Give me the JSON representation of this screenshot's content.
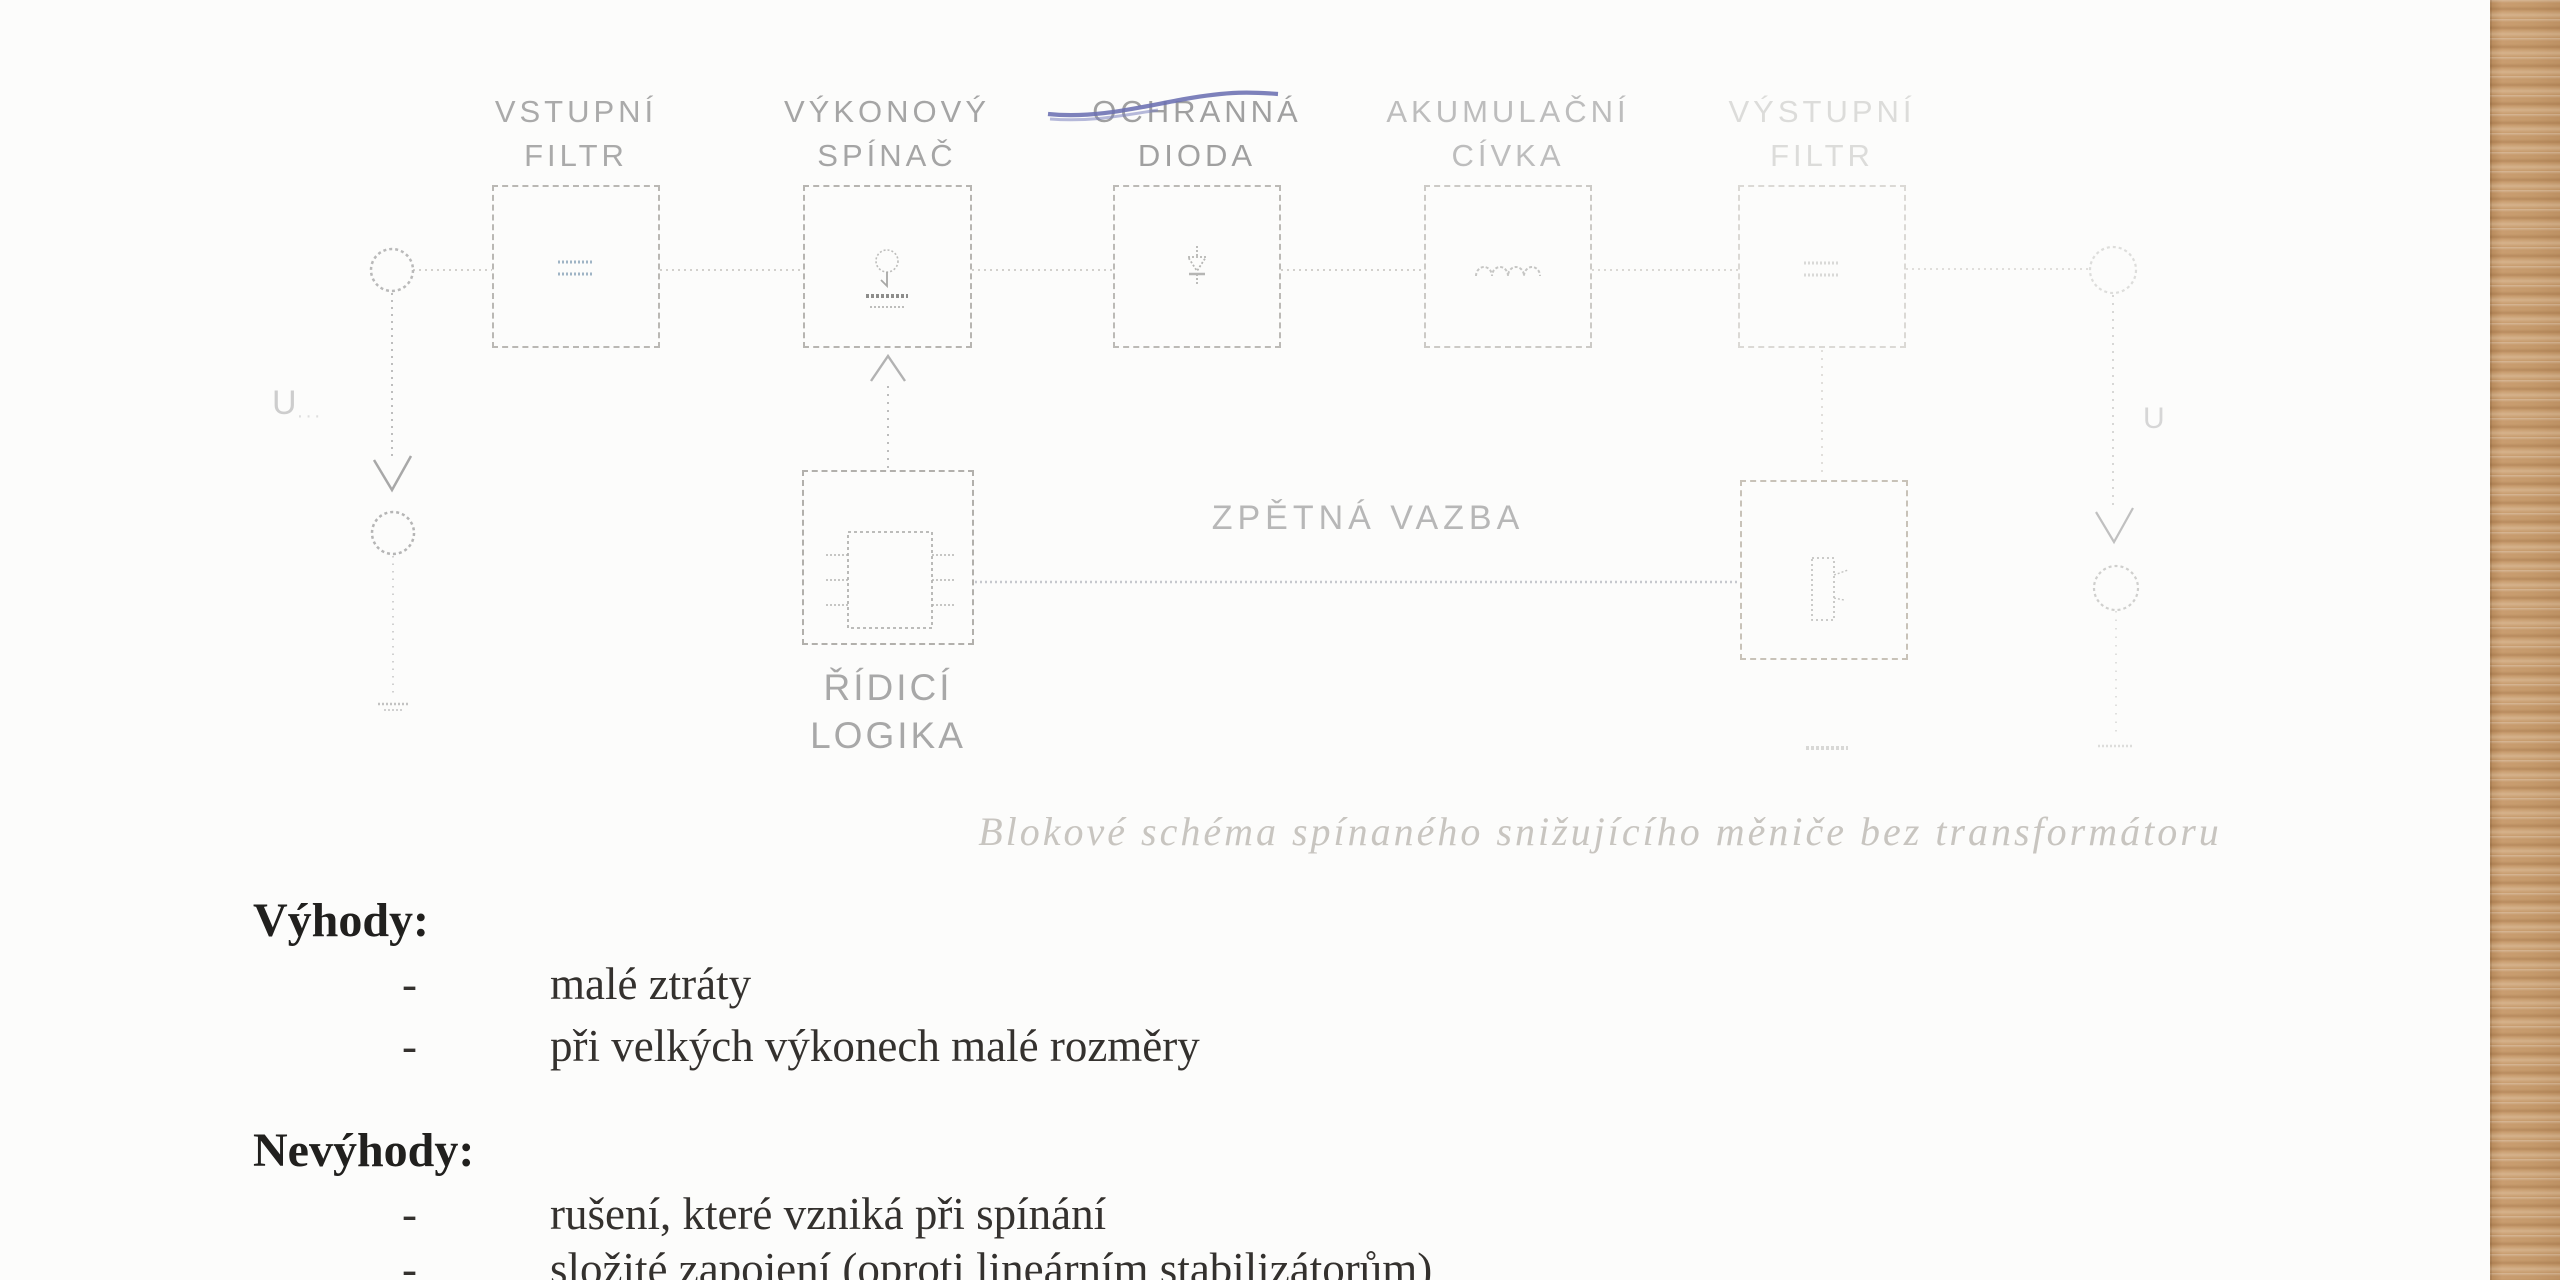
{
  "diagram": {
    "blocks": [
      {
        "line1": "VSTUPNÍ",
        "line2": "FILTR"
      },
      {
        "line1": "VÝKONOVÝ",
        "line2": "SPÍNAČ"
      },
      {
        "line1": "OCHRANNÁ",
        "line2": "DIODA"
      },
      {
        "line1": "AKUMULAČNÍ",
        "line2": "CÍVKA"
      },
      {
        "line1": "VÝSTUPNÍ",
        "line2": "FILTR"
      }
    ],
    "control_block": {
      "line1": "ŘÍDICÍ",
      "line2": "LOGIKA"
    },
    "feedback_label": "ZPĚTNÁ VAZBA",
    "input_terminal_label": "U",
    "input_terminal_sub": "···",
    "output_terminal_label": "U",
    "caption": "Blokové schéma spínaného snižujícího měniče bez transformátoru",
    "pen_stroke_color": "#6b70b2"
  },
  "content": {
    "bullet": "-",
    "advantages_heading": "Výhody:",
    "advantages": [
      "malé ztráty",
      "při velkých výkonech malé rozměry"
    ],
    "disadvantages_heading": "Nevýhody:",
    "disadvantages": [
      "rušení, které vzniká při spínání",
      "složité zapojení (oproti lineárním stabilizátorům)"
    ]
  },
  "background": {
    "paper_color": "#fcfcfb",
    "wood_color": "#c79c6f"
  }
}
